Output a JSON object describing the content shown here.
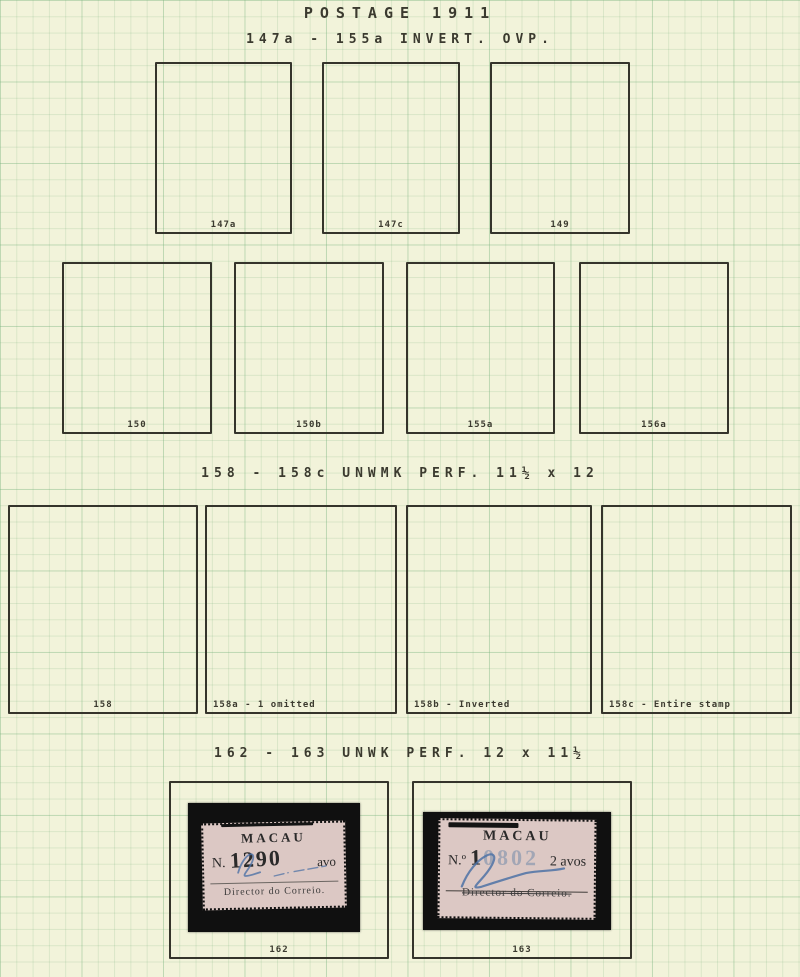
{
  "page_title": "POSTAGE 1911",
  "page_subtitle": "147a - 155a  INVERT. OVP.",
  "sections": {
    "invert_ovp": {
      "row1_labels": [
        "147a",
        "147c",
        "149"
      ],
      "row2_labels": [
        "150",
        "150b",
        "155a",
        "156a"
      ]
    },
    "unwmk_perf": {
      "header": "158 - 158c  UNWMK  PERF.  11½ x 12",
      "labels": [
        "158",
        "158a - 1 omitted",
        "158b - Inverted",
        "158c - Entire stamp"
      ]
    },
    "unwk_perf": {
      "header": "162 - 163  UNWK  PERF.  12 x 11½",
      "stamps": [
        {
          "box_label": "162",
          "country": "MACAU",
          "number_prefix": "N.",
          "serial_dark": "1290",
          "serial_light": "",
          "denomination": "avo",
          "footer": "Director do Correio."
        },
        {
          "box_label": "163",
          "country": "MACAU",
          "number_prefix": "N.º",
          "serial_dark": "1",
          "serial_light": "0802",
          "denomination": "2 avos",
          "footer": "Director do Correio."
        }
      ]
    }
  },
  "colors": {
    "paper": "#f2f3da",
    "grid_line": "#b9d8b4",
    "ink": "#3b3a2f",
    "stamp_paper": "#dcc8c4",
    "mount_black": "#101010",
    "signature_blue": "#4d72a6"
  }
}
